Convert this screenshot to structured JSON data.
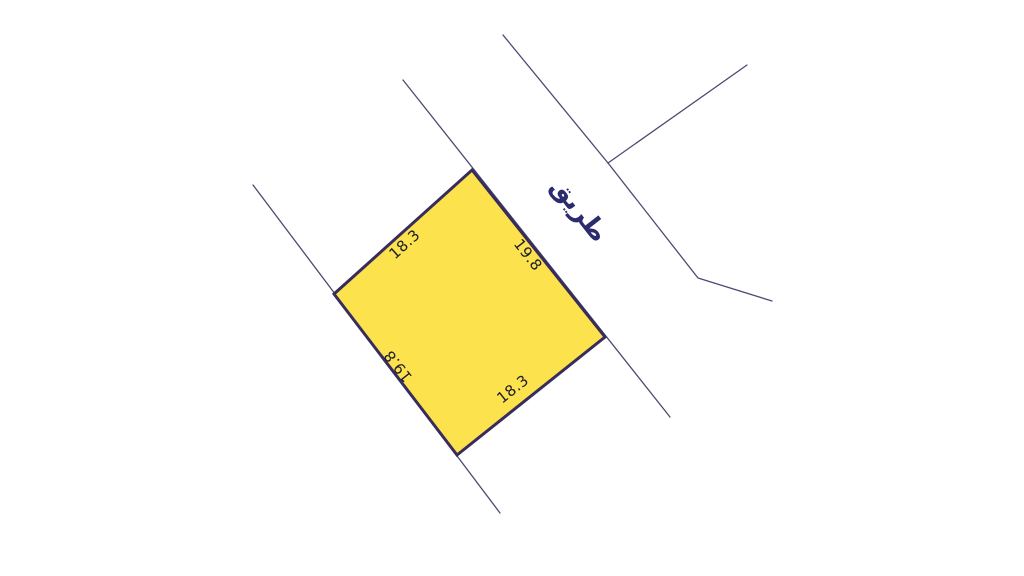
{
  "map": {
    "background_color": "#ffffff",
    "road_label": {
      "text": "طريق",
      "x": 573,
      "y": 215,
      "rotation": 52,
      "color": "#2b2b6e"
    },
    "parcel": {
      "fill_color": "#FCE24D",
      "stroke_color": "#372C5B",
      "stroke_width": 3,
      "vertices": [
        [
          472,
          170
        ],
        [
          605,
          337
        ],
        [
          457,
          455
        ],
        [
          334,
          294
        ]
      ],
      "dimension_color": "#1c1c2e",
      "dimensions": [
        {
          "text": "18.3",
          "x": 408,
          "y": 248,
          "rotation": -42,
          "edge": "top-left"
        },
        {
          "text": "19.8",
          "x": 524,
          "y": 258,
          "rotation": 52,
          "edge": "top-right"
        },
        {
          "text": "18.3",
          "x": 516,
          "y": 393,
          "rotation": -38.5,
          "edge": "bottom-right"
        },
        {
          "text": "19.8",
          "x": 402,
          "y": 363,
          "rotation": 232,
          "edge": "bottom-left"
        }
      ]
    },
    "road_lines": {
      "color": "#4a4a72",
      "width": 1.3,
      "polylines": [
        [
          [
            403,
            80
          ],
          [
            670,
            417
          ]
        ],
        [
          [
            253,
            185
          ],
          [
            500,
            513
          ]
        ],
        [
          [
            503,
            35
          ],
          [
            608,
            163
          ],
          [
            698,
            278
          ],
          [
            772,
            301
          ]
        ],
        [
          [
            608,
            163
          ],
          [
            747,
            65
          ]
        ]
      ]
    }
  }
}
